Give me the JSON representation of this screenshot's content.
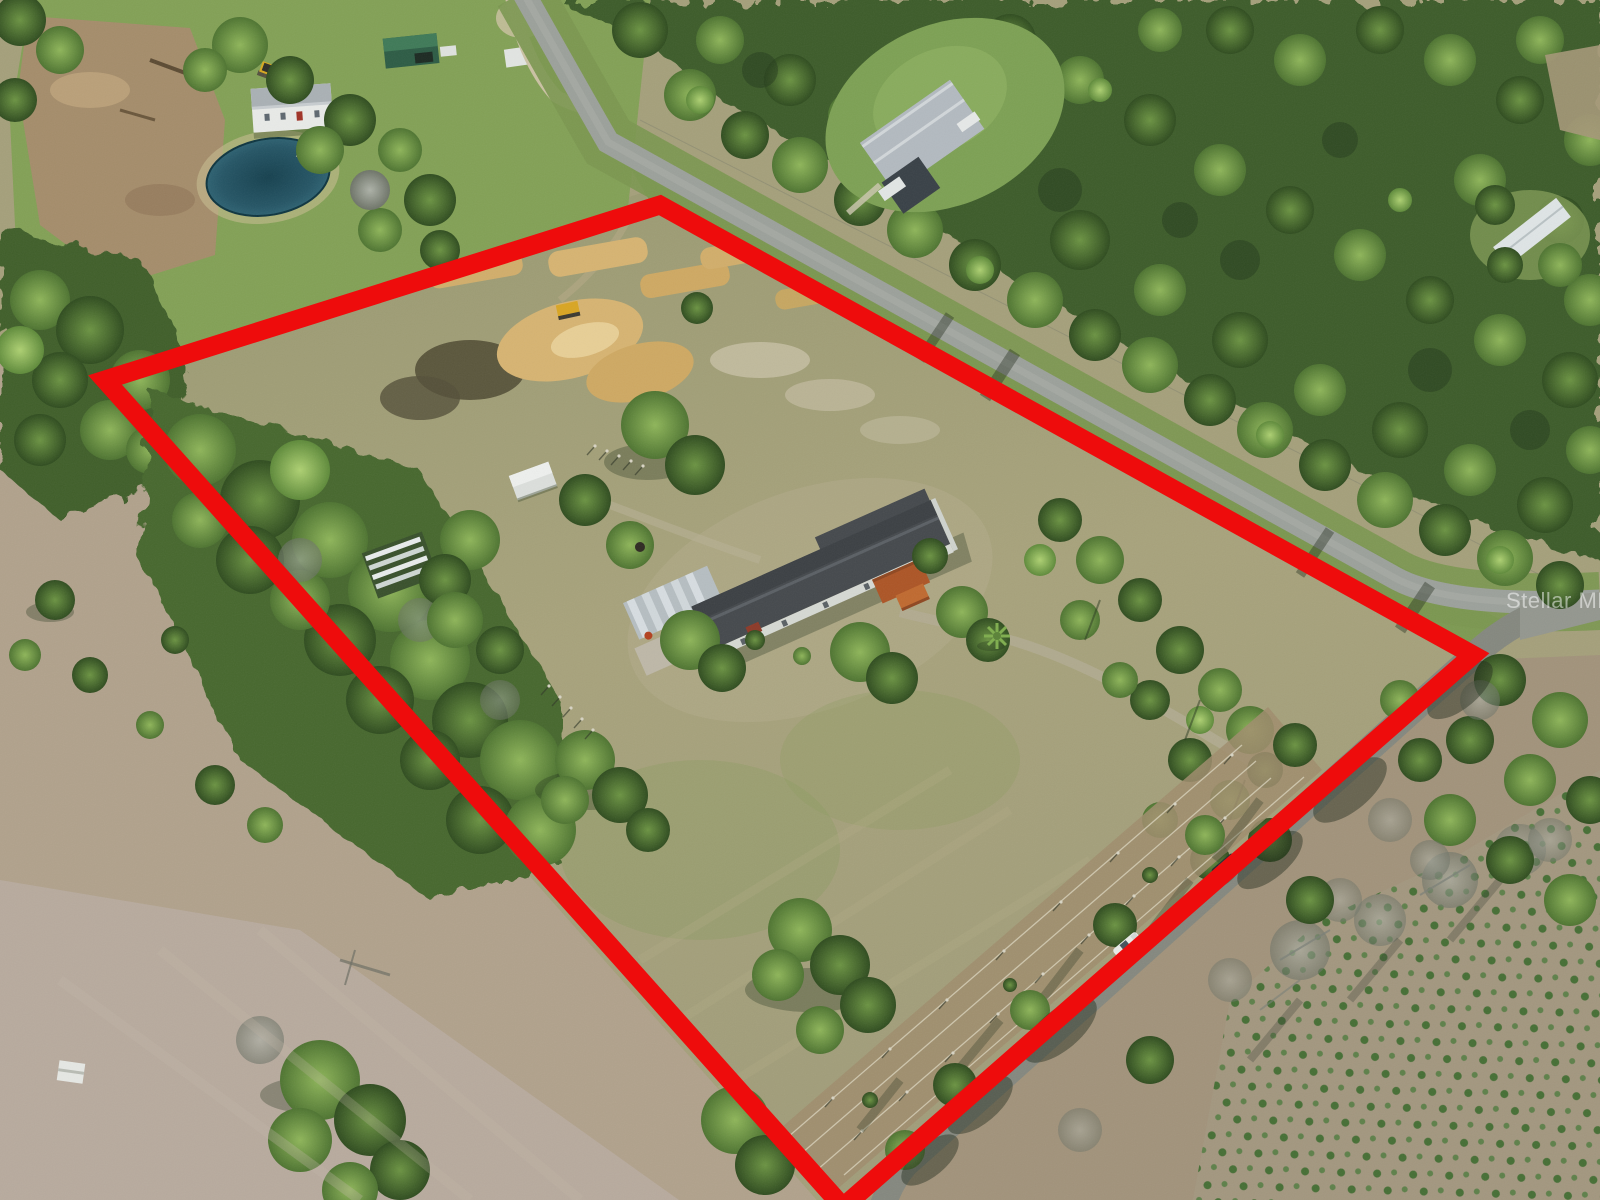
{
  "image": {
    "kind": "aerial-drone-photo",
    "subject": "rural acreage with mobile home, outbuildings and cleared land, property boundary outlined in red",
    "view": "oblique overhead"
  },
  "watermark": {
    "text": "Stellar MLS",
    "color": "#ffffff",
    "opacity": 0.5
  },
  "boundary": {
    "description": "red property-line overlay (quadrilateral)",
    "color": "#ee0c0c",
    "stroke_width": 19,
    "points_svg": "660,205 1473,655 843,1207 105,380"
  },
  "palette": {
    "field_green": "#83a156",
    "field_khaki": "#a5a07b",
    "field_tan": "#b1a28c",
    "field_pink_tan": "#b9aca0",
    "forest_dark": "#3c5c2a",
    "forest_mid": "#547a38",
    "forest_light": "#86ae54",
    "road_gray": "#9ca19b",
    "side_road_gray": "#85887f",
    "sand": "#d2ae6b",
    "pond_teal": "#16414f",
    "roof_dark": "#45494d",
    "carport_silver": "#b6bec2",
    "deck_orange": "#b0582a"
  },
  "landmarks": {
    "subject_house": "single-wide home, dark gray roof, silver metal carport, orange wood deck with stairs",
    "shed": "small white shed",
    "quonset_frame": "striped metal frame structure under oak",
    "pond": "dark round pond with small dock (neighboring parcel, upper left)",
    "neighbor_house_nw": "white house with gray roof (upper left)",
    "neighbor_house_ne": "gray-roofed house in trees (upper right of road)",
    "excavator": "yellow excavator (upper left)",
    "skid_steer": "yellow skid steer beside sand piles",
    "sand_piles": "graded tan sand strips and spoil mounds",
    "main_road": "gray paved road running diagonally past the parcel",
    "side_road": "tree-shaded side road along the south-east line",
    "white_vehicle": "white vehicle parked on side road",
    "dark_vehicle": "dark vehicle parked on side road",
    "fence_strip": "parallel wire-fence lanes along inside of south-east line",
    "pine_saplings": "rows of young planted pines, bottom right",
    "white_box": "small white box structure in open field, bottom left"
  }
}
